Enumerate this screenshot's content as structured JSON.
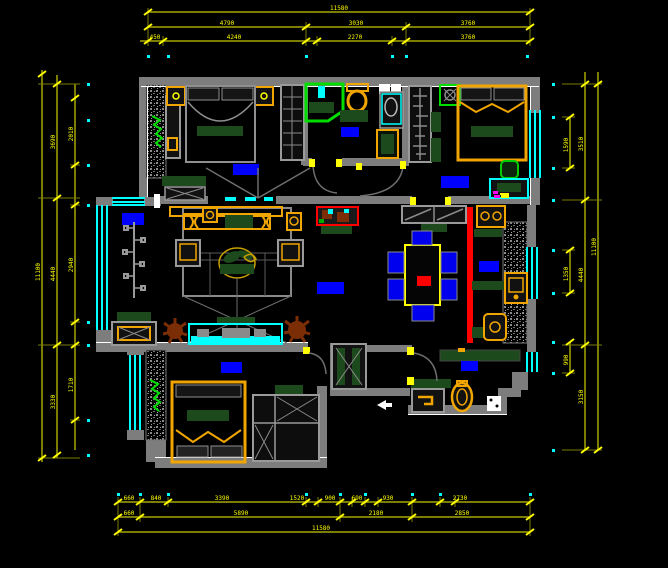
{
  "title": "apartment-floor-plan",
  "colors": {
    "background": "#000000",
    "wall": "#7d7d7d",
    "wall_edge": "#ffffff",
    "dimension_line": "#7d7d00",
    "dimension_text": "#ffff00",
    "window": "#00ffff",
    "furniture_wood": "#f0a500",
    "furniture_dark_green": "#1d4a1d",
    "plant_green": "#00dd00",
    "label_blue": "#0000ff",
    "accent_red": "#ff0000",
    "plant_brown": "#7b2d05"
  },
  "dimensions": {
    "top": {
      "total": "11580",
      "row2": [
        "4790",
        "3030",
        "3760"
      ],
      "row3": [
        "450",
        "4240",
        "2270",
        "3760"
      ]
    },
    "bottom": {
      "row1": [
        "660",
        "840",
        "3390",
        "1520",
        "900",
        "690",
        "930",
        "2730"
      ],
      "row2": [
        "660",
        "5890",
        "2180",
        "2850"
      ],
      "total": "11580"
    },
    "left": {
      "total": "11100",
      "mid": [
        "3690",
        "4440",
        "3330"
      ],
      "inner": [
        "2010",
        "2940",
        "1710"
      ]
    },
    "right": {
      "total": "11100",
      "mid": [
        "3510",
        "4440",
        "3150"
      ],
      "inner": [
        "1590",
        "1350",
        "990"
      ]
    }
  },
  "rooms": {
    "labels": [
      {
        "id": "master-bedroom"
      },
      {
        "id": "bathroom"
      },
      {
        "id": "bedroom-2"
      },
      {
        "id": "balcony"
      },
      {
        "id": "hallway"
      },
      {
        "id": "kitchen"
      },
      {
        "id": "bedroom-3"
      },
      {
        "id": "entry"
      }
    ]
  }
}
